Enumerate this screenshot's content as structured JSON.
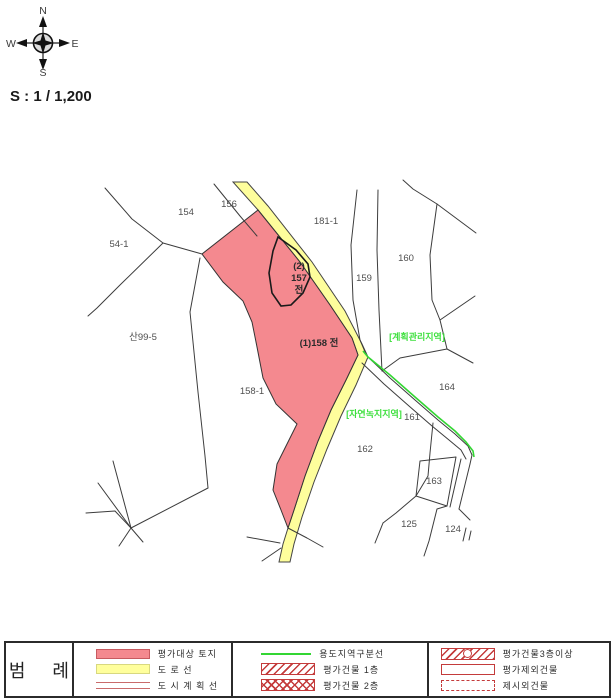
{
  "compass": {
    "north": "N",
    "south": "S",
    "west": "W",
    "east": "E"
  },
  "scale": {
    "label": "S : 1 / 1,200"
  },
  "map": {
    "labels": {
      "p154": "154",
      "p156": "156",
      "p54_1": "54-1",
      "p181_1": "181-1",
      "p157_line1": "(2)",
      "p157_line2": "157",
      "p157_line3": "전",
      "p159": "159",
      "p160": "160",
      "san99_5": "산99-5",
      "p158": "(1)158 전",
      "p158_1": "158-1",
      "zone_plan_mgmt": "[계획관리지역]",
      "p164": "164",
      "zone_nat_green": "[자연녹지지역]",
      "p161": "161",
      "p162": "162",
      "p163": "163",
      "p125": "125",
      "p124": "124"
    }
  },
  "legend": {
    "title": "범 례",
    "col1": [
      {
        "label": "평가대상 토지",
        "swatch": "target-parcel"
      },
      {
        "label": "도 로 선",
        "swatch": "road-line"
      },
      {
        "label": "도 시 계 획 선",
        "swatch": "city-plan-line"
      }
    ],
    "col2": [
      {
        "label": "용도지역구분선",
        "swatch": "zone-division-line"
      },
      {
        "label": "평가건물 1층",
        "swatch": "building-1f"
      },
      {
        "label": "평가건물 2층",
        "swatch": "building-2f"
      }
    ],
    "col3": [
      {
        "label": "평가건물3층이상",
        "swatch": "building-3f-plus"
      },
      {
        "label": "평가제외건물",
        "swatch": "excluded-building"
      },
      {
        "label": "제시외건물",
        "swatch": "unlisted-building"
      }
    ]
  },
  "colors": {
    "target_parcel_fill": "#F4898F",
    "road_fill": "#FEFE9C",
    "zone_line_green": "#33D633",
    "zone_text_green": "#3FE03F",
    "legend_red": "#C43B3B",
    "city_plan_line_red": "#C96A6A",
    "boundary_line": "#3C3C3C"
  }
}
